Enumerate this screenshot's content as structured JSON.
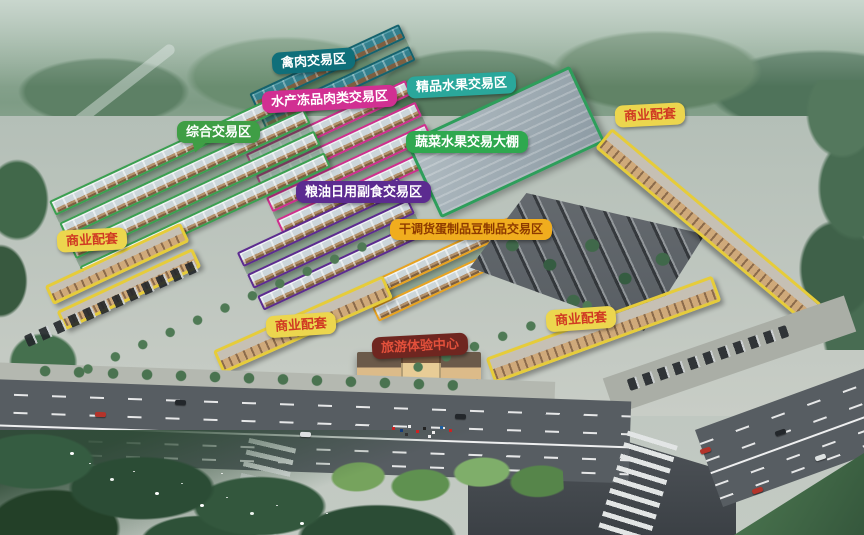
{
  "labels": {
    "poultry": {
      "text": "禽肉交易区",
      "bg": "#0f6f7a",
      "fg": "#ffffff"
    },
    "seafood": {
      "text": "水产冻品肉类交易区",
      "bg": "#d13092",
      "fg": "#ffffff"
    },
    "fruit_premium": {
      "text": "精品水果交易区",
      "bg": "#2aa79b",
      "fg": "#ffffff"
    },
    "veg_shed": {
      "text": "蔬菜水果交易大棚",
      "bg": "#2fa84f",
      "fg": "#ffffff"
    },
    "comprehensive": {
      "text": "综合交易区",
      "bg": "#3f9e45",
      "fg": "#ffffff"
    },
    "grain_oil": {
      "text": "粮油日用副食交易区",
      "bg": "#5c2b90",
      "fg": "#ffffff"
    },
    "dried_goods": {
      "text": "干调货蛋制品豆制品交易区",
      "bg": "#f0ad1e",
      "fg": "#8d3a00"
    },
    "commercial": {
      "text": "商业配套",
      "bg": "#ecd64e",
      "fg": "#d03a23"
    },
    "tourism": {
      "text": "旅游体验中心",
      "bg": "#6f2620",
      "fg": "#e2503b"
    }
  },
  "zones": {
    "comprehensive": {
      "outline": "#3aa050"
    },
    "seafood": {
      "outline": "#cf2f8e"
    },
    "poultry": {
      "outline": "#14626e"
    },
    "grain_oil": {
      "outline": "#5c2b90"
    },
    "dried_goods": {
      "outline": "#e9a31f"
    },
    "veg_shed": {
      "outline": "#2e9e5b"
    },
    "commercial": {
      "outline": "#e6cc3a"
    }
  }
}
